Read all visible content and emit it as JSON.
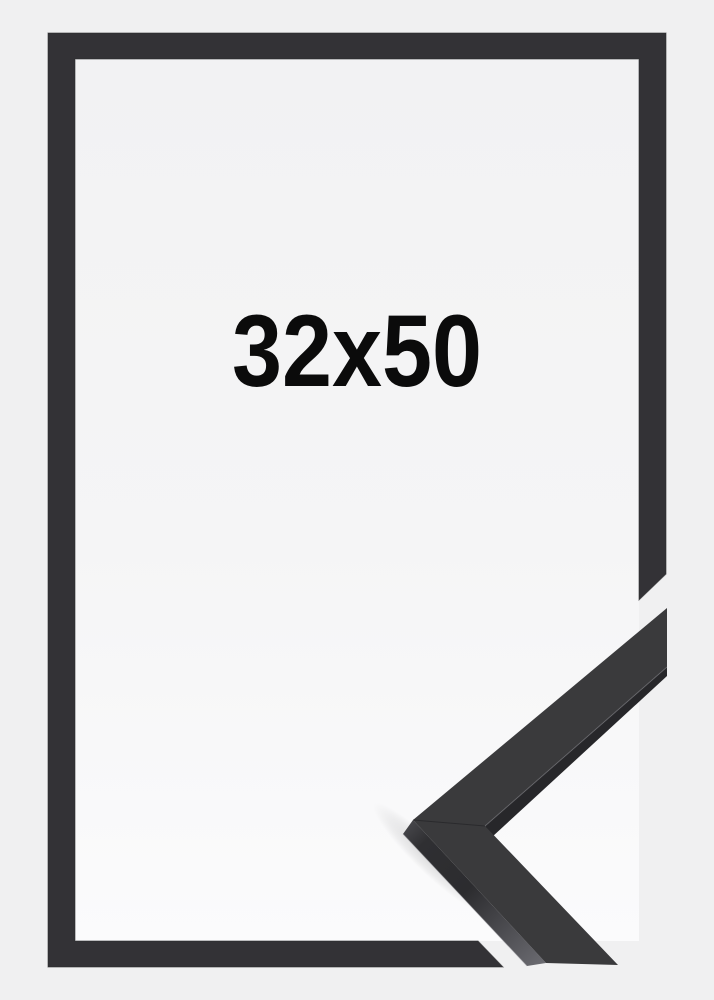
{
  "product": {
    "size_label": "32x50"
  },
  "colors": {
    "background": "#f0f0f1",
    "frame": "#333236",
    "frame_edge": "#2b2b2d",
    "sample_face": "#3a3a3c",
    "label_text": "#0b0b0b"
  }
}
